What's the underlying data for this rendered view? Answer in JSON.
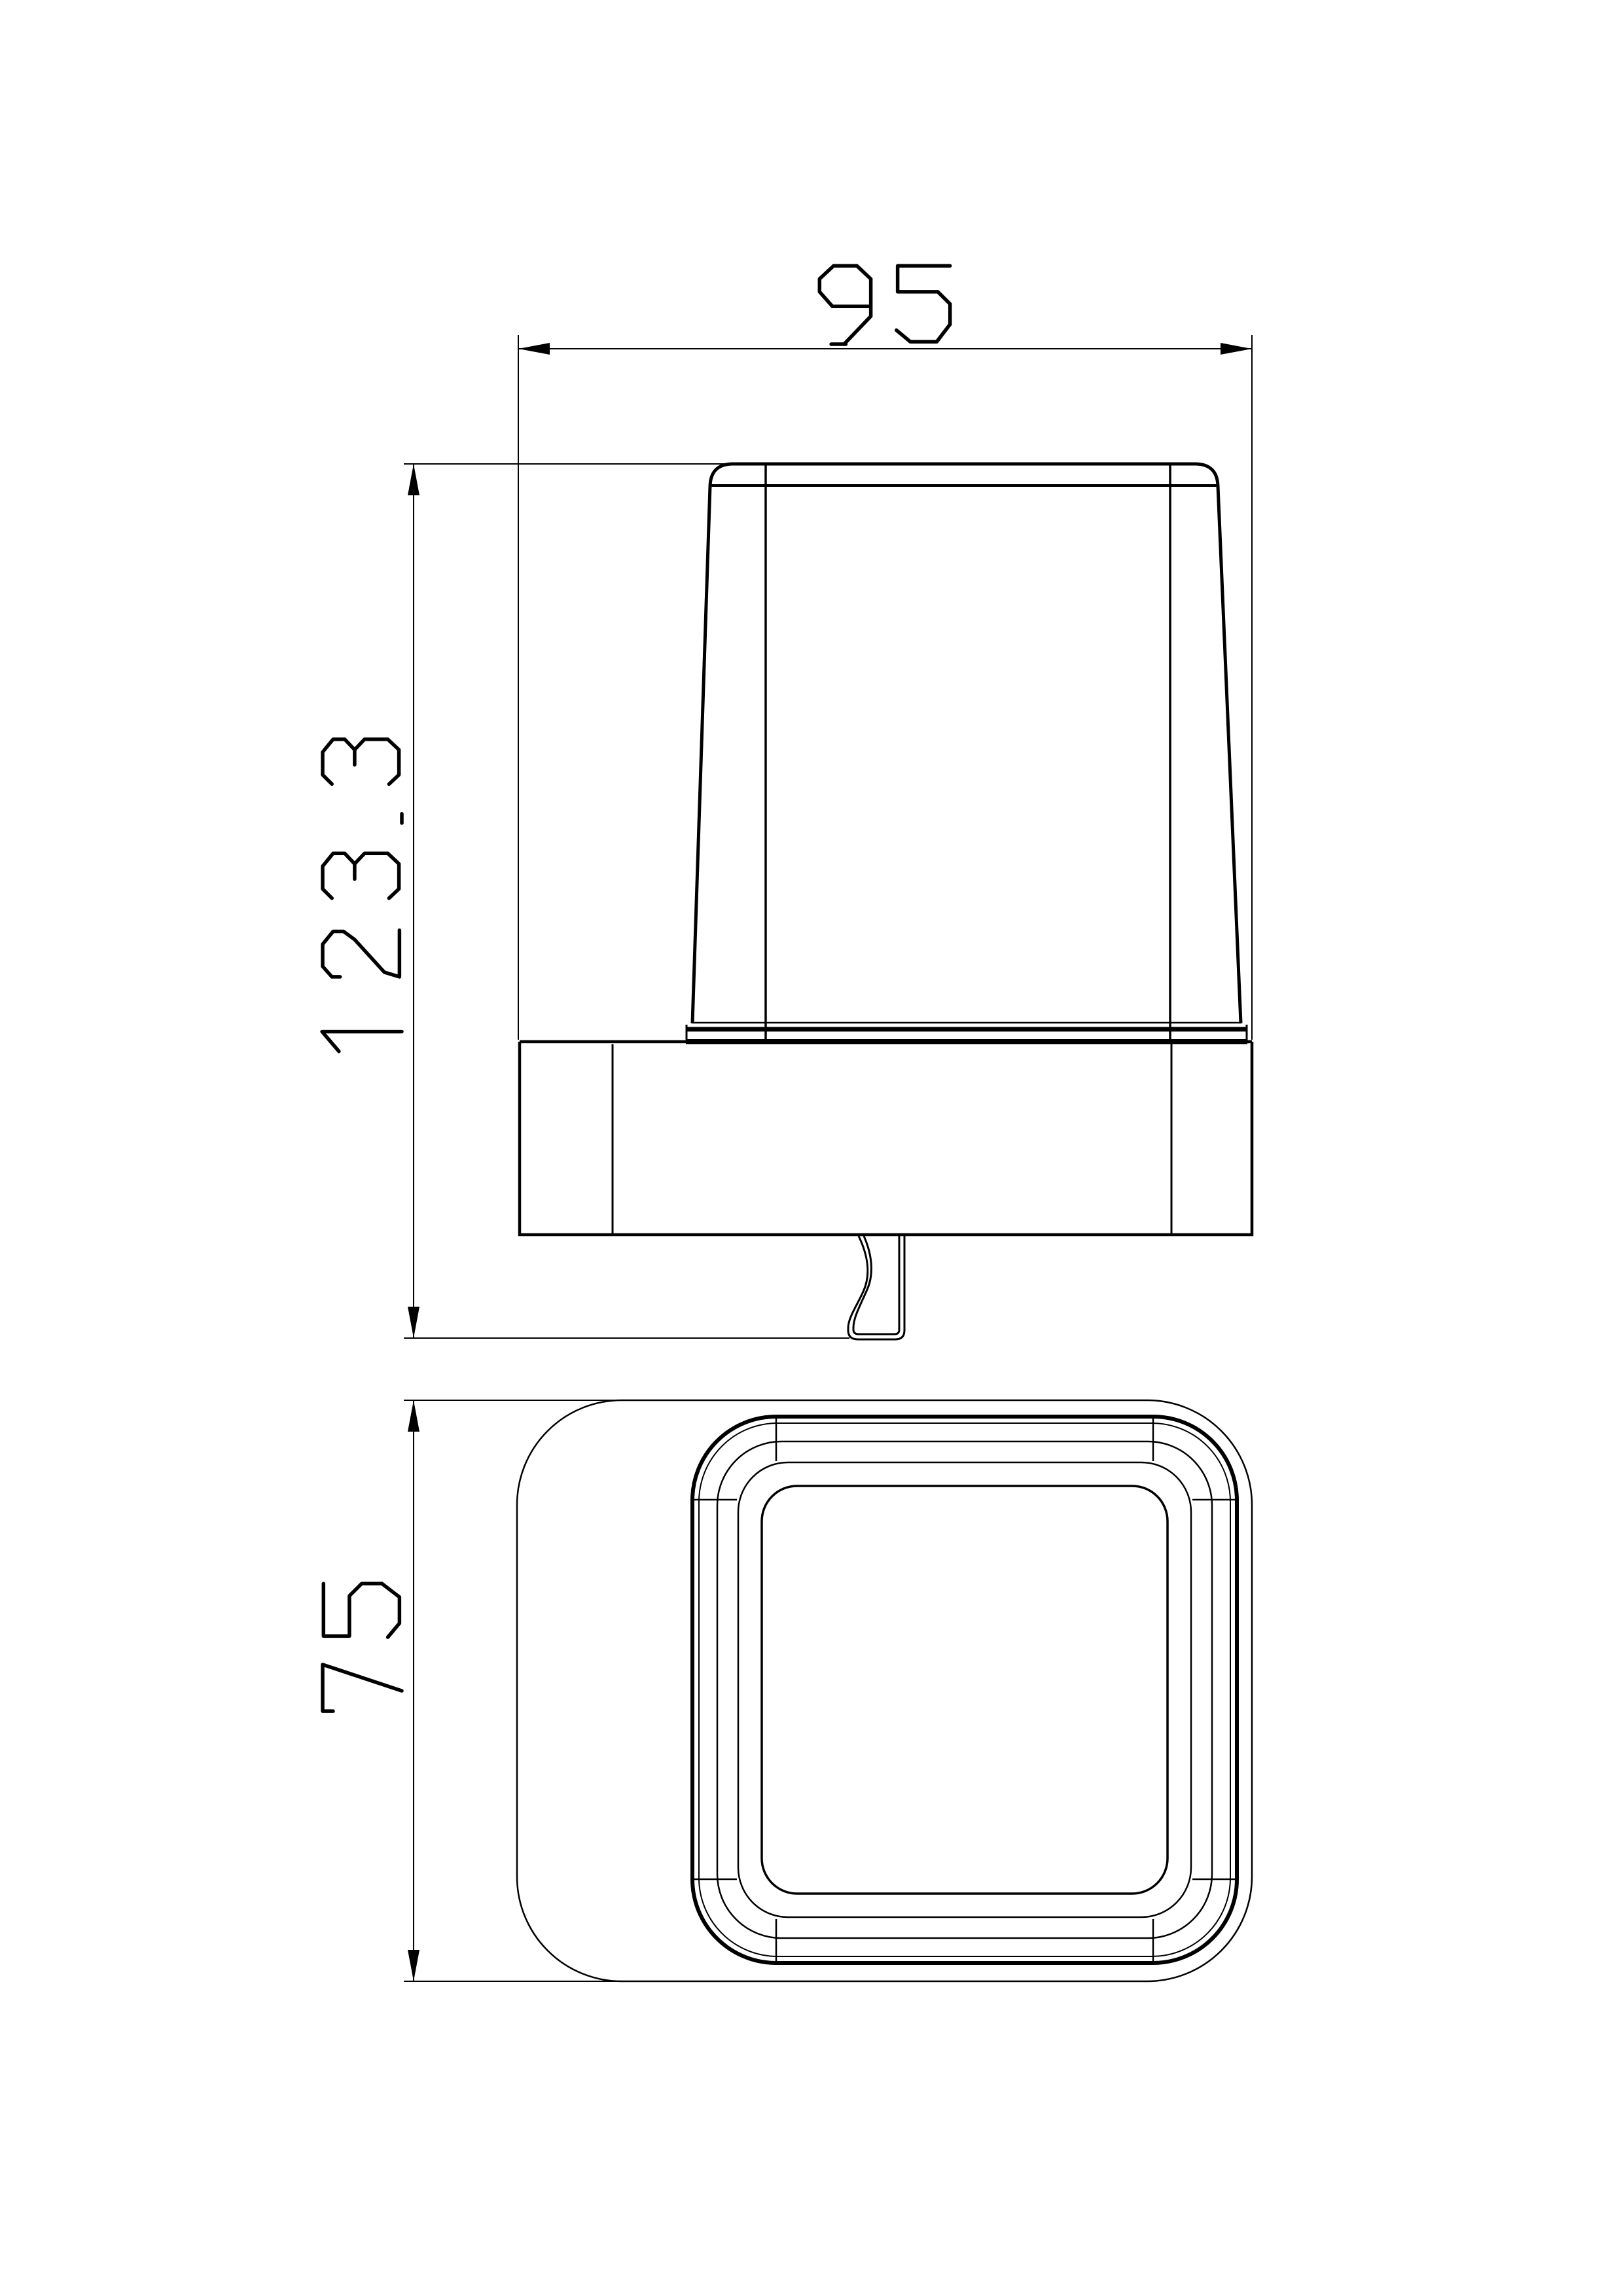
{
  "sheet": {
    "paper_color": "#ffffff",
    "ink_color": "#000000"
  },
  "dims": {
    "width": {
      "value": "95"
    },
    "height": {
      "value": "123.3"
    },
    "depth": {
      "value": "75"
    }
  }
}
